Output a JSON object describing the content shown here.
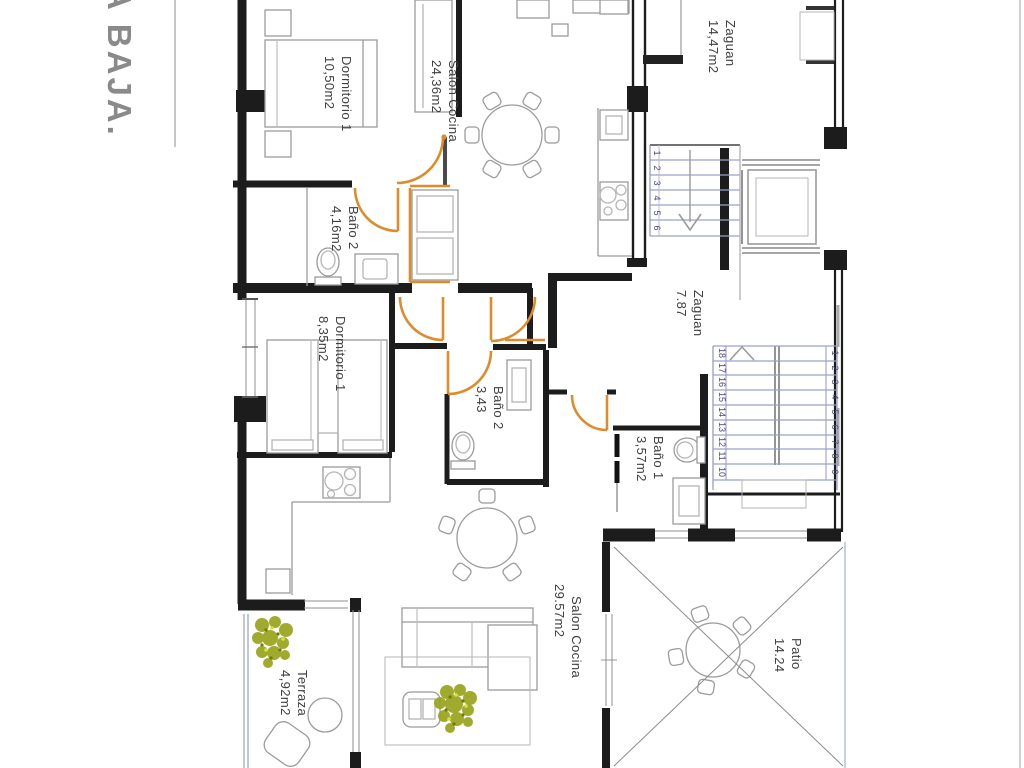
{
  "title": "A BAJA.",
  "rooms": {
    "dormitorio1": {
      "name": "Dormitorio 1",
      "area": "10,50m2"
    },
    "bano2_top": {
      "name": "Baño 2",
      "area": "4,16m2"
    },
    "salon_cocina_top": {
      "name": "Salon Cocina",
      "area": "24,36m2"
    },
    "zaguan_top": {
      "name": "Zaguan",
      "area": "14,47m2"
    },
    "zaguan_mid": {
      "name": "Zaguan",
      "area": "7.87"
    },
    "dormitorio2": {
      "name": "Dormitorio 1",
      "area": "8,35m2"
    },
    "bano2_mid": {
      "name": "Baño 2",
      "area": "3,43"
    },
    "bano1": {
      "name": "Baño 1",
      "area": "3,57m2"
    },
    "salon_cocina_bottom": {
      "name": "Salon Cocina",
      "area": "29.57m2"
    },
    "patio": {
      "name": "Patio",
      "area": "14.24"
    },
    "terraza": {
      "name": "Terraza",
      "area": "4,92m2"
    }
  },
  "stairs": {
    "upper_flight": [
      "1",
      "2",
      "3",
      "4",
      "5",
      "6"
    ],
    "main_flight_right": [
      "1",
      "2",
      "3",
      "4",
      "5",
      "6",
      "7",
      "8",
      "9"
    ],
    "main_flight_left": [
      "18",
      "17",
      "16",
      "15",
      "14",
      "13",
      "12",
      "11",
      "10"
    ]
  },
  "colors": {
    "door_accent": "#DE8C2B",
    "stair_number": "#4A4A78",
    "title_gray": "#8A8A8A",
    "plant_olive": "#97A21C",
    "wall_black": "#1C1C1C"
  }
}
